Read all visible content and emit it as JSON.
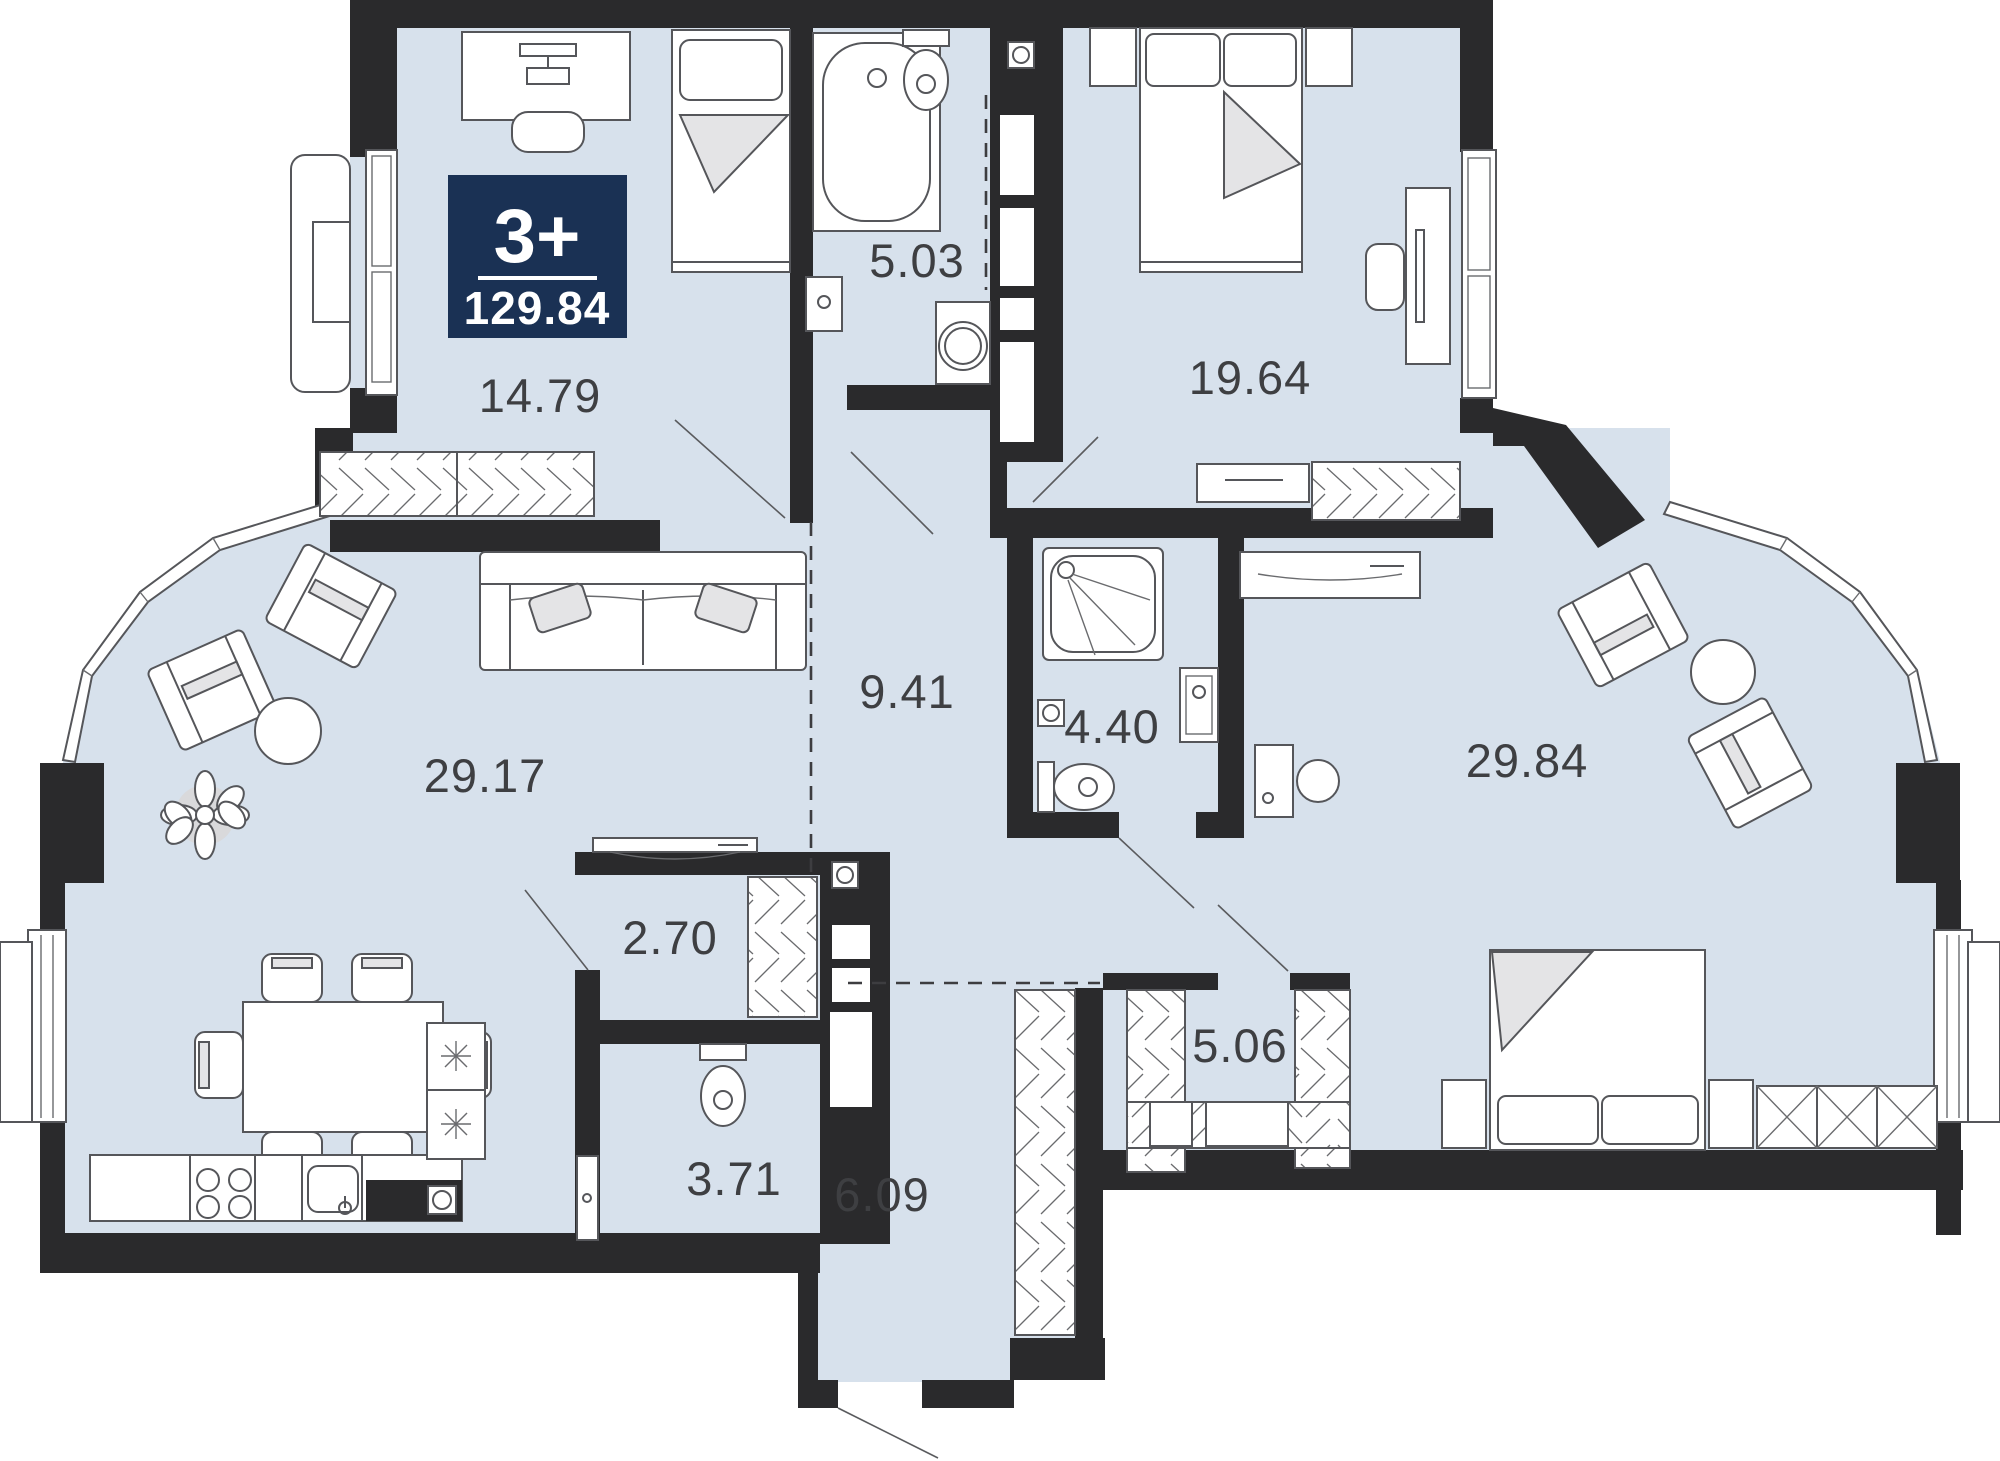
{
  "badge": {
    "rooms_label": "3+",
    "total_area": "129.84",
    "background": "#1a3154",
    "text_color": "#ffffff"
  },
  "rooms": [
    {
      "name": "bedroom-1",
      "area": "14.79"
    },
    {
      "name": "bathroom-main",
      "area": "5.03"
    },
    {
      "name": "bedroom-2",
      "area": "19.64"
    },
    {
      "name": "corridor",
      "area": "9.41"
    },
    {
      "name": "shower-room",
      "area": "4.40"
    },
    {
      "name": "living-kitchen",
      "area": "29.17"
    },
    {
      "name": "bedroom-master",
      "area": "29.84"
    },
    {
      "name": "closet",
      "area": "2.70"
    },
    {
      "name": "wc",
      "area": "3.71"
    },
    {
      "name": "hallway",
      "area": "6.09"
    },
    {
      "name": "wardrobe-room",
      "area": "5.06"
    }
  ],
  "colors": {
    "wall": "#2a2a2c",
    "floor": "#d7e1ec",
    "badge": "#1a3154",
    "furniture_line": "#55565a",
    "label": "#3e3f42"
  }
}
